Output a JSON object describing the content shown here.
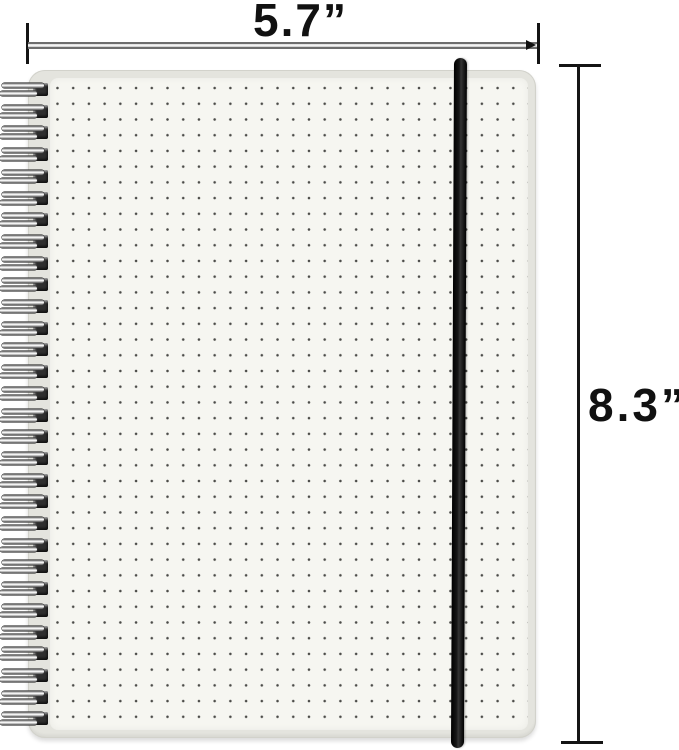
{
  "annotations": {
    "width_label": "5.7”",
    "height_label": "8.3”"
  },
  "notebook": {
    "description": "Spiral-bound dot grid notebook with black elastic band closure",
    "spiral_coils": 30,
    "spiral_first_center_y": 90,
    "spiral_pitch": 21.7,
    "colors": {
      "cover": "#e4e4de",
      "page": "#f6f6f1",
      "dots": "#4b4b48",
      "elastic_band": "#0b0b0b",
      "spiral_wire": "#c6c6c6",
      "dimension_lines": "#141414"
    }
  }
}
